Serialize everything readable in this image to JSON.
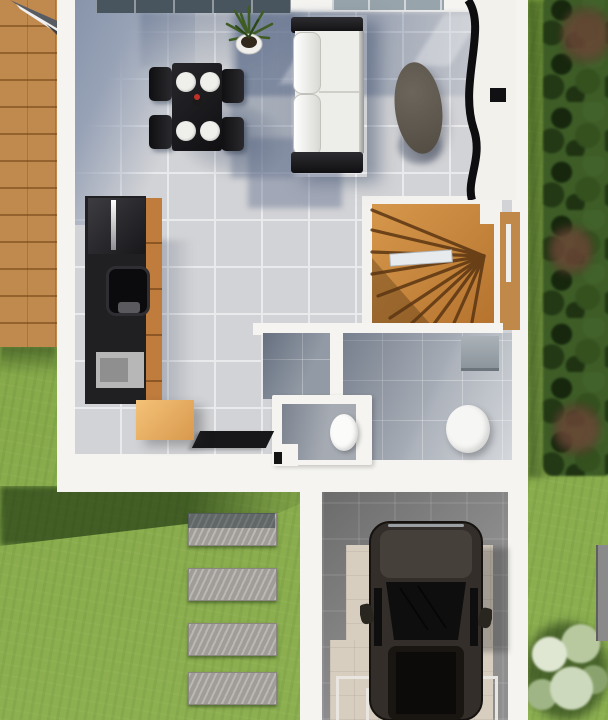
{
  "scene": {
    "description": "Top-down 3D architectural render of a house ground floor with open living-dining room, kitchen, WC, bathroom, winder staircase, garage with parked car, wooden deck, stepping-stone path and garden",
    "rooms": [
      "living-dining-area",
      "kitchen",
      "hallway",
      "wc",
      "bathroom",
      "staircase-well",
      "garage"
    ],
    "exterior_features": [
      "lawn",
      "hedge-border",
      "wooden-deck",
      "stepping-stones",
      "garage-driveway",
      "blossom-tree",
      "roof-corner-overhang"
    ]
  },
  "objects": {
    "dining_chairs_count": 4,
    "dining_plates_count": 4,
    "stepping_stones_count": 4,
    "furniture_and_fixtures": [
      "dining-table",
      "dining-chairs",
      "table-vase",
      "potted-plant",
      "sofa",
      "oval-coffee-table",
      "curved-partition",
      "kitchen-cabinet-run",
      "kitchen-sink",
      "kitchen-hob",
      "kitchen-island-box",
      "doormat",
      "winder-staircase",
      "stair-handrail",
      "toilet",
      "round-shower-basin",
      "wall-cabinet",
      "suv-car",
      "garage-door-track-frame",
      "window-strip",
      "skylight-strip",
      "garden-panel"
    ]
  },
  "palette": {
    "grass": "#85a847",
    "grass_shadow": "#2a4a18",
    "hedge": "#3d5c26",
    "hedge_bloom": "#5d4334",
    "deck_wood": "#c0894e",
    "wall_white": "#f5f4f1",
    "tile_light": "#d2d3d6",
    "tile_shadow_blue": "#75849c",
    "stair_wood": "#c9883f",
    "stair_step_edge": "#5b3512",
    "kitchen_black": "#1f1f21",
    "kitchen_wood": "#bf7c3d",
    "island_tan": "#eab264",
    "sofa_frame_black": "#1c1c1e",
    "sofa_cushion_white": "#f2f1ee",
    "coffee_table_gray": "#5b554c",
    "bath_floor_gray": "#9aa1aa",
    "sanitary_white": "#fafafa",
    "garage_concrete": "#8f8f8f",
    "garage_pavers_beige": "#d8cec0",
    "car_body": "#38332e",
    "car_glass": "#121212",
    "stone_gray": "#9c9995",
    "window_glass_dark": "#48545e"
  }
}
